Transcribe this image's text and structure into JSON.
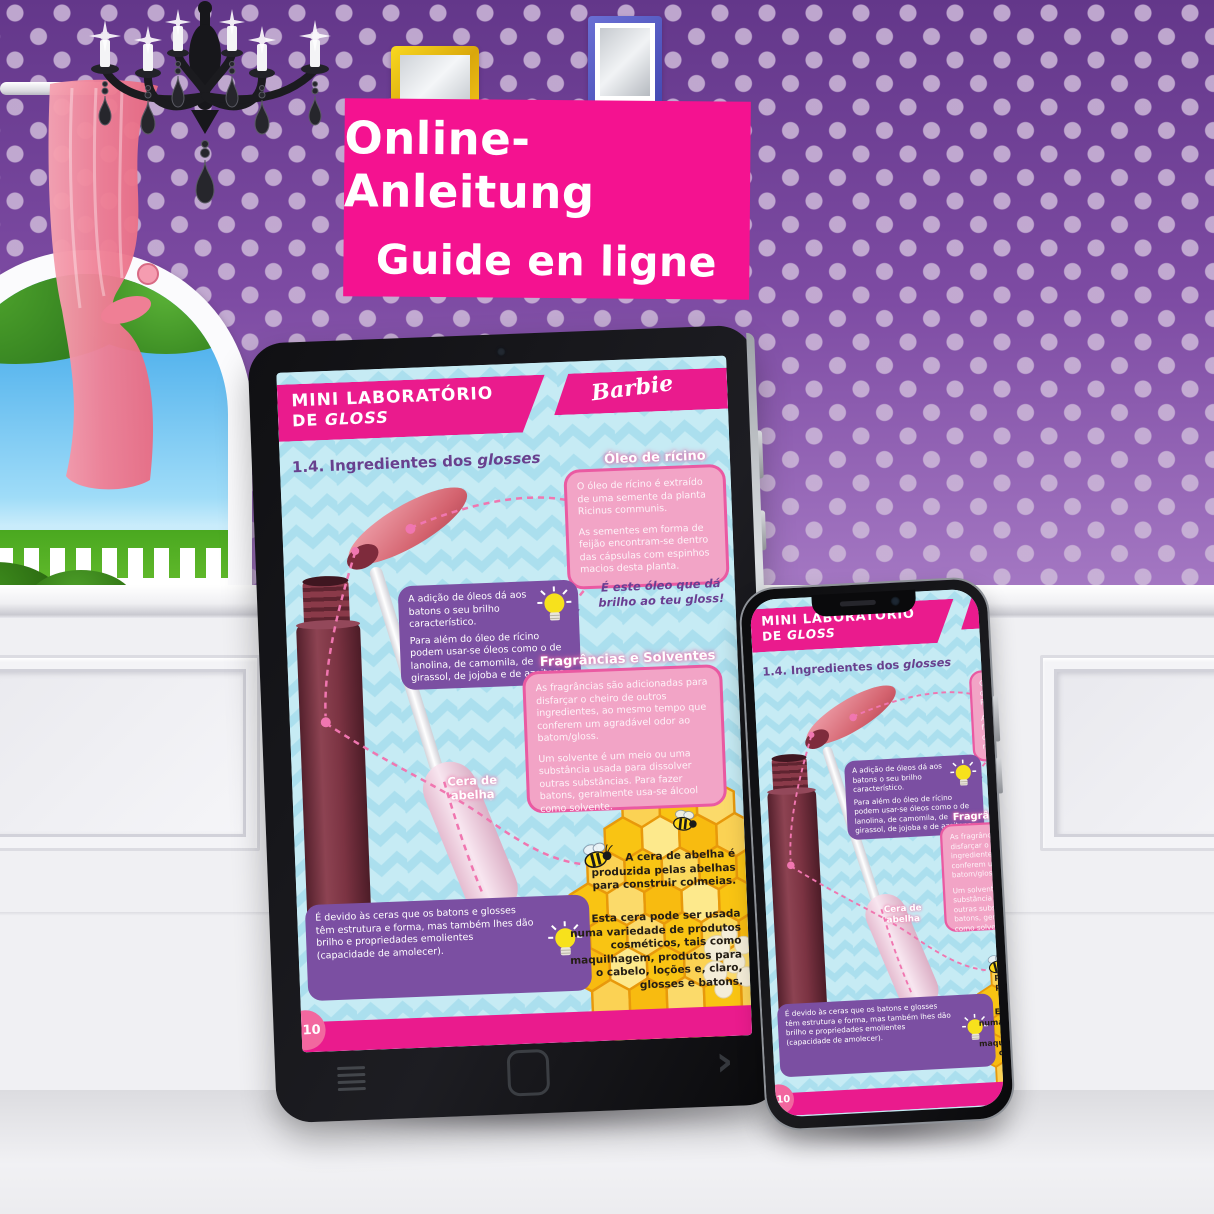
{
  "banner": {
    "line1": "Online-Anleitung",
    "line2": "Guide en ligne"
  },
  "page": {
    "header": {
      "title_line1": "MINI LABORATÓRIO",
      "title_line2_prefix": "DE ",
      "title_line2_italic": "GLOSS",
      "brand": "Barbie"
    },
    "section_title": {
      "prefix": "1.4. Ingredientes dos ",
      "italic": "glosses"
    },
    "castor": {
      "title": "Óleo de rícino",
      "p1": "O óleo de rícino é extraído de uma semente da planta Ricinus communis.",
      "p2": "As sementes em forma de feijão encontram-se dentro das cápsulas com espinhos macios desta planta."
    },
    "oils": {
      "p1": "A adição de óleos dá aos batons o seu brilho característico.",
      "p2": "Para além do óleo de rícino podem usar-se óleos como o de lanolina, de camomila, de girassol, de jojoba e de azeitona."
    },
    "gloss_note": "É este óleo que dá brilho ao teu gloss!",
    "fragrances": {
      "title": "Fragrâncias e Solventes",
      "p1": "As fragrâncias são adicionadas para disfarçar o cheiro de outros ingredientes, ao mesmo tempo que conferem um agradável odor ao batom/gloss.",
      "p2": "Um solvente é um meio ou uma substância usada para dissolver outras substâncias. Para fazer batons, geralmente usa-se álcool como solvente."
    },
    "beeswax_label": "Cera de abelha",
    "beeswax_fact1": "A cera de abelha é produzida pelas abelhas para construir colmeias.",
    "beeswax_fact2": "Esta cera pode ser usada numa variedade de produtos cosméticos, tais como maquilhagem, produtos para o cabelo, loções e, claro, glosses e batons.",
    "wax_tip": "É devido às ceras que os batons e glosses têm estrutura e forma, mas também lhes dão brilho e propriedades emolientes (capacidade de amolecer).",
    "page_number": "10"
  },
  "colors": {
    "banner_pink": "#f41290",
    "header_pink": "#ea1b8d",
    "callout_purple": "#7b4fa2",
    "callout_pink": "#f2a4c6",
    "callout_pink_border": "#ea5aa2",
    "page_blue": "#c6ebf4",
    "chevron_blue": "#abdfee",
    "honey_yellow": "#f9c413",
    "wallpaper_purple": "#7d4ba3",
    "tube_maroon": "#7b3342"
  }
}
